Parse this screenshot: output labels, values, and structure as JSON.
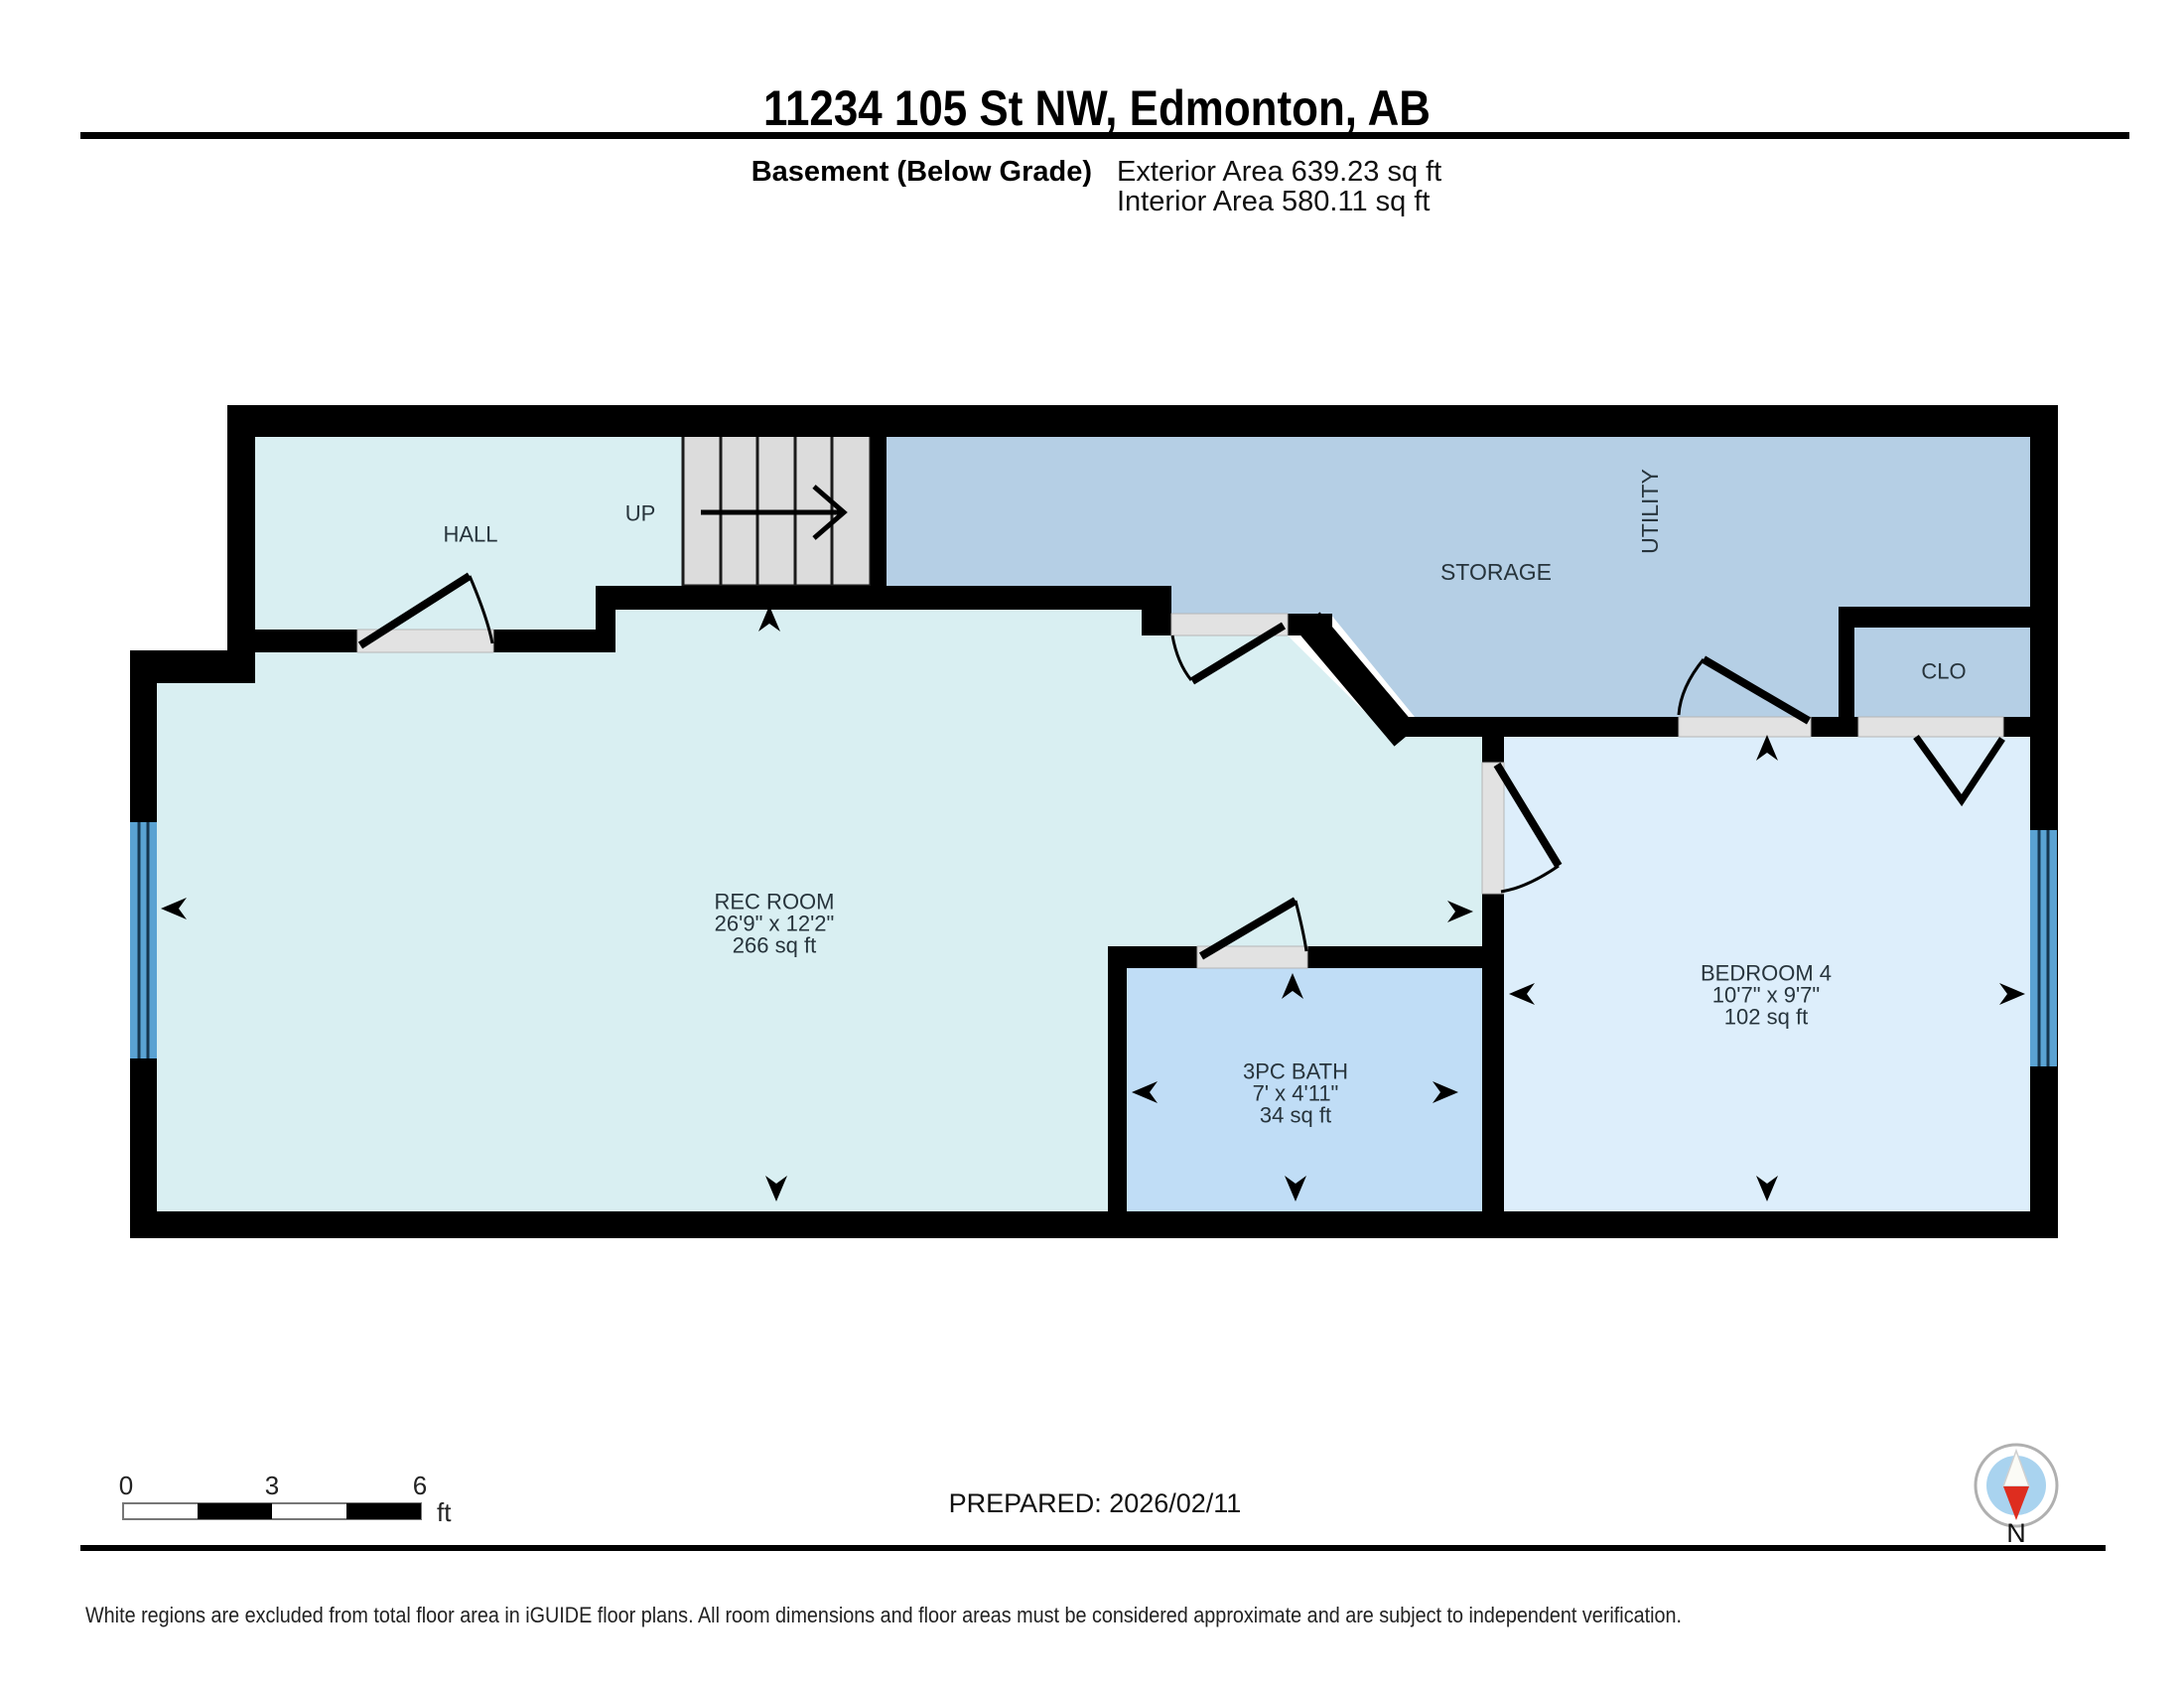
{
  "header": {
    "title": "11234 105 St NW, Edmonton, AB",
    "floor_label": "Basement (Below Grade)",
    "exterior_area": "Exterior Area 639.23 sq ft",
    "interior_area": "Interior Area 580.11 sq ft"
  },
  "rooms": {
    "hall": {
      "name": "HALL"
    },
    "stairs": {
      "direction_label": "UP"
    },
    "storage": {
      "name": "STORAGE"
    },
    "utility": {
      "name": "UTILITY"
    },
    "closet": {
      "name": "CLO"
    },
    "rec_room": {
      "name": "REC ROOM",
      "dimensions": "26'9\" x 12'2\"",
      "area": "266 sq ft"
    },
    "bath": {
      "name": "3PC BATH",
      "dimensions": "7' x 4'11\"",
      "area": "34 sq ft"
    },
    "bedroom": {
      "name": "BEDROOM 4",
      "dimensions": "10'7\" x 9'7\"",
      "area": "102 sq ft"
    }
  },
  "scale_bar": {
    "start": "0",
    "middle": "3",
    "end": "6",
    "unit": "ft"
  },
  "compass": {
    "label": "N"
  },
  "footer": {
    "prepared": "PREPARED: 2026/02/11",
    "disclaimer": "White regions are excluded from total floor area in iGUIDE floor plans. All room dimensions and floor areas must be considered approximate and are subject to independent verification."
  },
  "colors": {
    "wall": "#000000",
    "room_light": "#d9eff2",
    "room_medium": "#b5cfe5",
    "room_bath": "#c0ddf6",
    "room_bedroom": "#ddeefb",
    "stairs_fill": "#dcdcdc",
    "door_opening": "#e2e2e2",
    "window": "#5aa2d2",
    "compass_inner": "#a9d3ef",
    "compass_north": "#de2d1f"
  }
}
